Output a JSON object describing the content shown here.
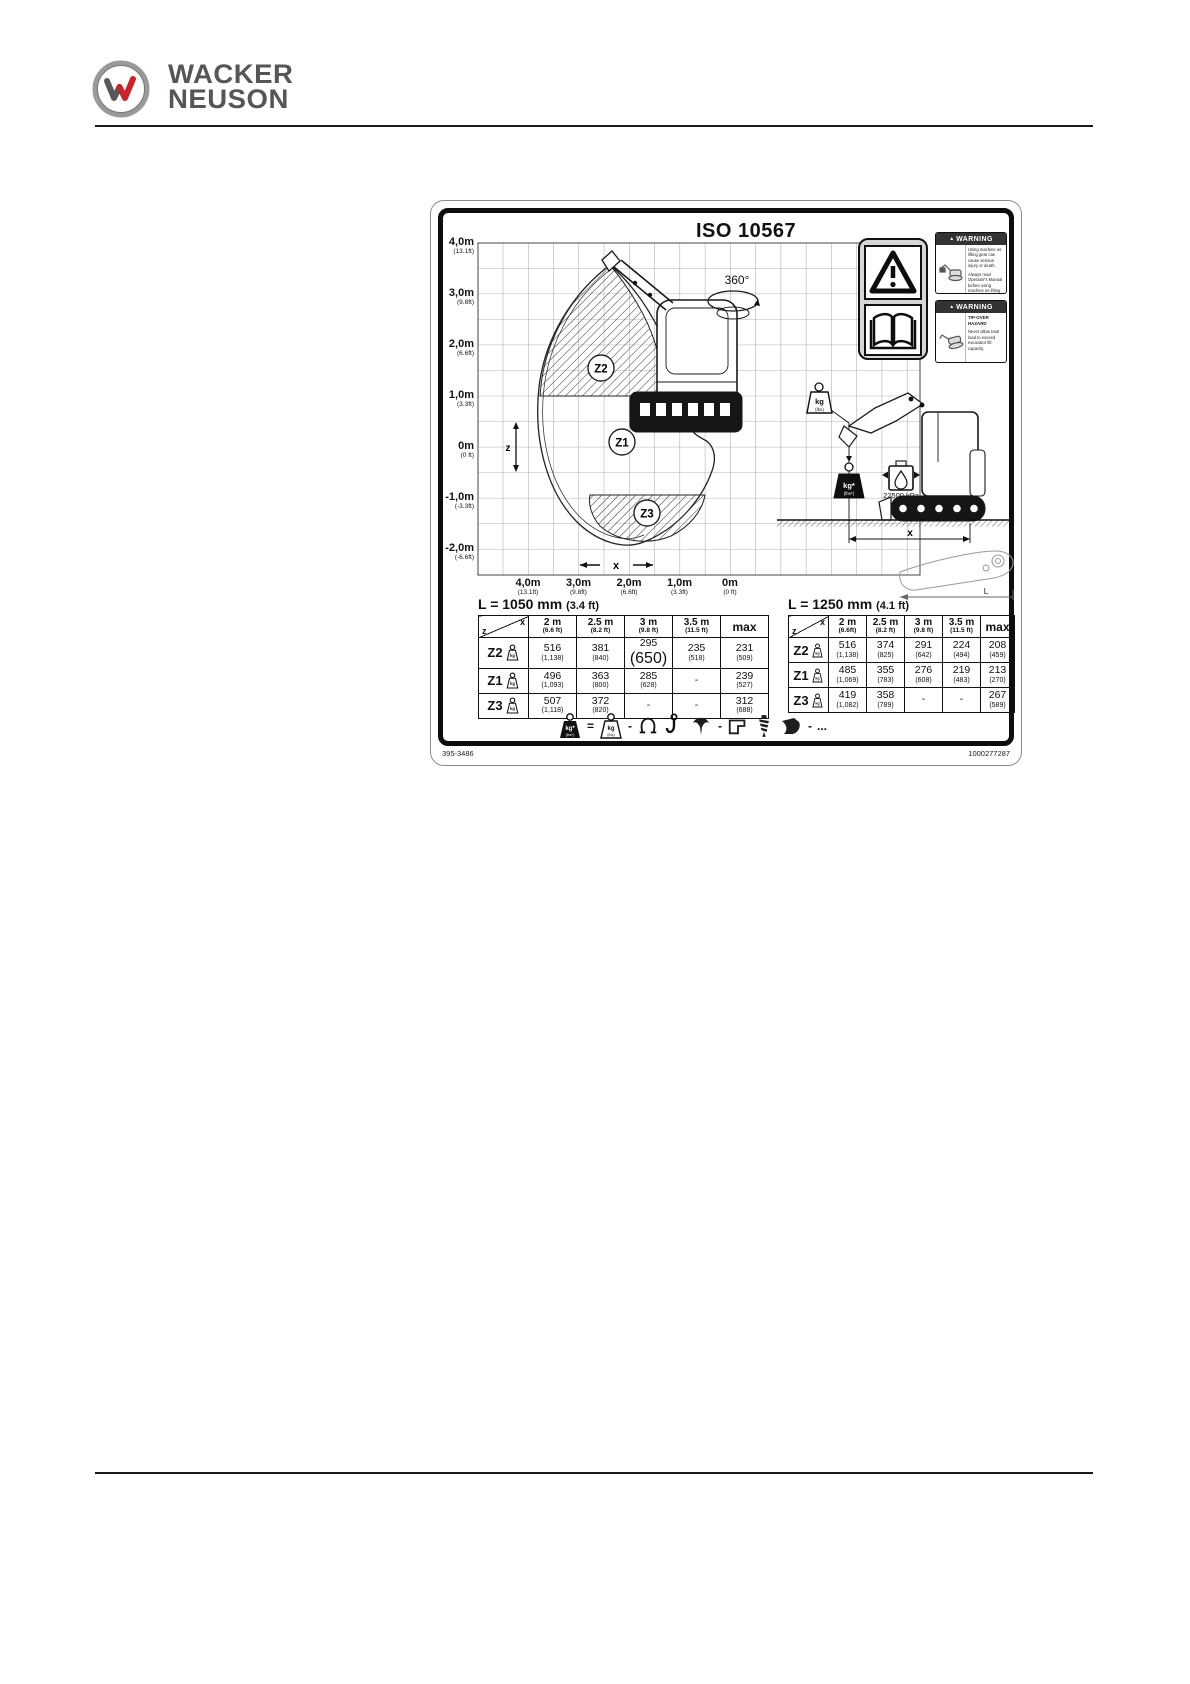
{
  "page": {
    "header_brand_top": "WACKER",
    "header_brand_bottom": "NEUSON"
  },
  "figure": {
    "standard_title": "ISO 10567",
    "rotation_label": "360°",
    "pressure_label": "22500 kPa",
    "code_left": "395-3486",
    "code_right": "1000277287",
    "marks": {
      "x_dim": "x",
      "z_dim": "z",
      "side_x_dim": "x",
      "arm_length": "L"
    },
    "zones": {
      "z1": "Z1",
      "z2": "Z2",
      "z3": "Z3"
    },
    "weights": {
      "outline_main": "kg",
      "outline_sub": "(lbs)",
      "solid_main": "kg*",
      "solid_sub": "(lbs*)"
    },
    "axis": {
      "y_ticks": [
        [
          "4,0m",
          "(13.1ft)"
        ],
        [
          "3,0m",
          "(9.8ft)"
        ],
        [
          "2,0m",
          "(6.6ft)"
        ],
        [
          "1,0m",
          "(3.3ft)"
        ],
        [
          "0m",
          "(0 ft)"
        ],
        [
          "-1,0m",
          "(-3.3ft)"
        ],
        [
          "-2,0m",
          "(-6.6ft)"
        ]
      ],
      "x_ticks": [
        [
          "4,0m",
          "(13.1ft)"
        ],
        [
          "3,0m",
          "(9.8ft)"
        ],
        [
          "2,0m",
          "(6.6ft)"
        ],
        [
          "1,0m",
          "(3.3ft)"
        ],
        [
          "0m",
          "(0 ft)"
        ]
      ]
    },
    "warnings": [
      {
        "marker": "▲",
        "title": "WARNING",
        "para1": "Using machine as lifting gear can cause serious injury or death.",
        "para2": "Always read Operator's Manual before using machine as lifting gear."
      },
      {
        "marker": "▲",
        "title": "WARNING",
        "para1": "TIP-OVER HAZARD",
        "para2": "Never allow total load to exceed excavator lift capacity."
      }
    ],
    "tables": [
      {
        "title": "L = 1050 mm",
        "title_ft": "(3.4 ft)",
        "corner_x": "x",
        "corner_z": "z",
        "max_label": "max",
        "cols": [
          [
            "2 m",
            "(6.6 ft)"
          ],
          [
            "2.5 m",
            "(8.2 ft)"
          ],
          [
            "3 m",
            "(9.8 ft)"
          ],
          [
            "3.5 m",
            "(11.5 ft)"
          ]
        ],
        "rows": [
          {
            "zone": "Z2",
            "c1": "516",
            "c1s": "(1,138)",
            "c2": "381",
            "c2s": "(840)",
            "c3": "295",
            "c3s": "(650)",
            "c4": "235",
            "c4s": "(518)",
            "cm": "231",
            "cms": "(509)"
          },
          {
            "zone": "Z1",
            "c1": "496",
            "c1s": "(1,093)",
            "c2": "363",
            "c2s": "(800)",
            "c3": "285",
            "c3s": "(628)",
            "c4": "-",
            "c4s": "",
            "cm": "239",
            "cms": "(527)"
          },
          {
            "zone": "Z3",
            "c1": "507",
            "c1s": "(1,118)",
            "c2": "372",
            "c2s": "(820)",
            "c3": "-",
            "c3s": "",
            "c4": "-",
            "c4s": "",
            "cm": "312",
            "cms": "(688)"
          }
        ]
      },
      {
        "title": "L = 1250 mm",
        "title_ft": "(4.1 ft)",
        "corner_x": "x",
        "corner_z": "z",
        "max_label": "max",
        "cols": [
          [
            "2 m",
            "(6.6ft)"
          ],
          [
            "2.5 m",
            "(8.2 ft)"
          ],
          [
            "3 m",
            "(9.8 ft)"
          ],
          [
            "3.5 m",
            "(11.5 ft)"
          ]
        ],
        "rows": [
          {
            "zone": "Z2",
            "c1": "516",
            "c1s": "(1,138)",
            "c2": "374",
            "c2s": "(825)",
            "c3": "291",
            "c3s": "(642)",
            "c4": "224",
            "c4s": "(494)",
            "cm": "208",
            "cms": "(459)"
          },
          {
            "zone": "Z1",
            "c1": "485",
            "c1s": "(1,069)",
            "c2": "355",
            "c2s": "(783)",
            "c3": "276",
            "c3s": "(608)",
            "c4": "219",
            "c4s": "(483)",
            "cm": "213",
            "cms": "(270)"
          },
          {
            "zone": "Z3",
            "c1": "419",
            "c1s": "(1,082)",
            "c2": "358",
            "c2s": "(789)",
            "c3": "-",
            "c3s": "",
            "c4": "-",
            "c4s": "",
            "cm": "267",
            "cms": "(589)"
          }
        ]
      }
    ],
    "legend": {
      "equals": "=",
      "dash": "-",
      "ellipsis": "..."
    }
  }
}
